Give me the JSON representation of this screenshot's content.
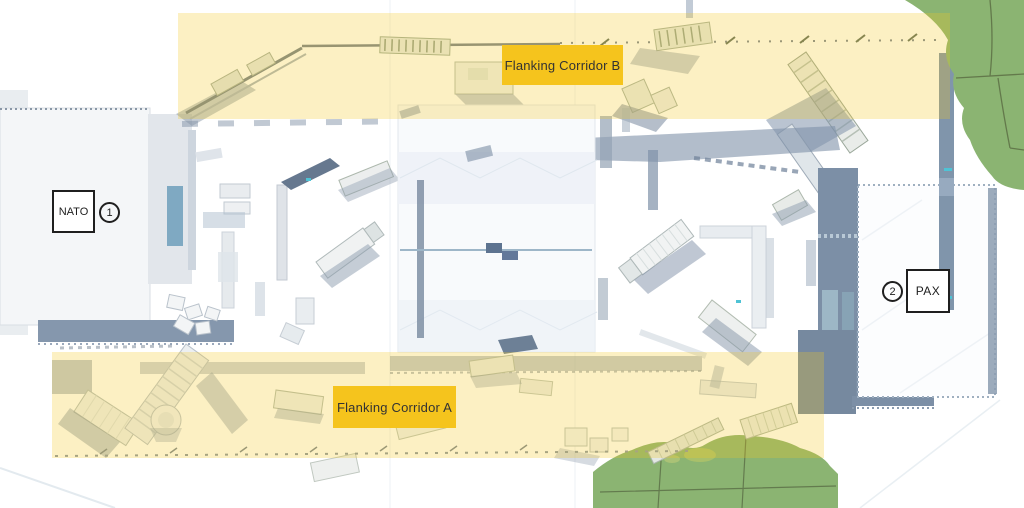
{
  "map": {
    "corridors": [
      {
        "id": "corridor-b",
        "label": "Flanking Corridor B"
      },
      {
        "id": "corridor-a",
        "label": "Flanking Corridor A"
      }
    ],
    "spawns": [
      {
        "number": "1",
        "label": "NATO"
      },
      {
        "number": "2",
        "label": "PAX"
      }
    ],
    "colors": {
      "corridor_overlay": "#F3C623",
      "corridor_label_bg": "#F5C41D",
      "corridor_label_text": "#333333",
      "marker_border": "#1F1F1F",
      "marker_bg": "#FFFFFF",
      "foliage": "#8BB472",
      "shadow_blue": "#7E90A8"
    }
  }
}
